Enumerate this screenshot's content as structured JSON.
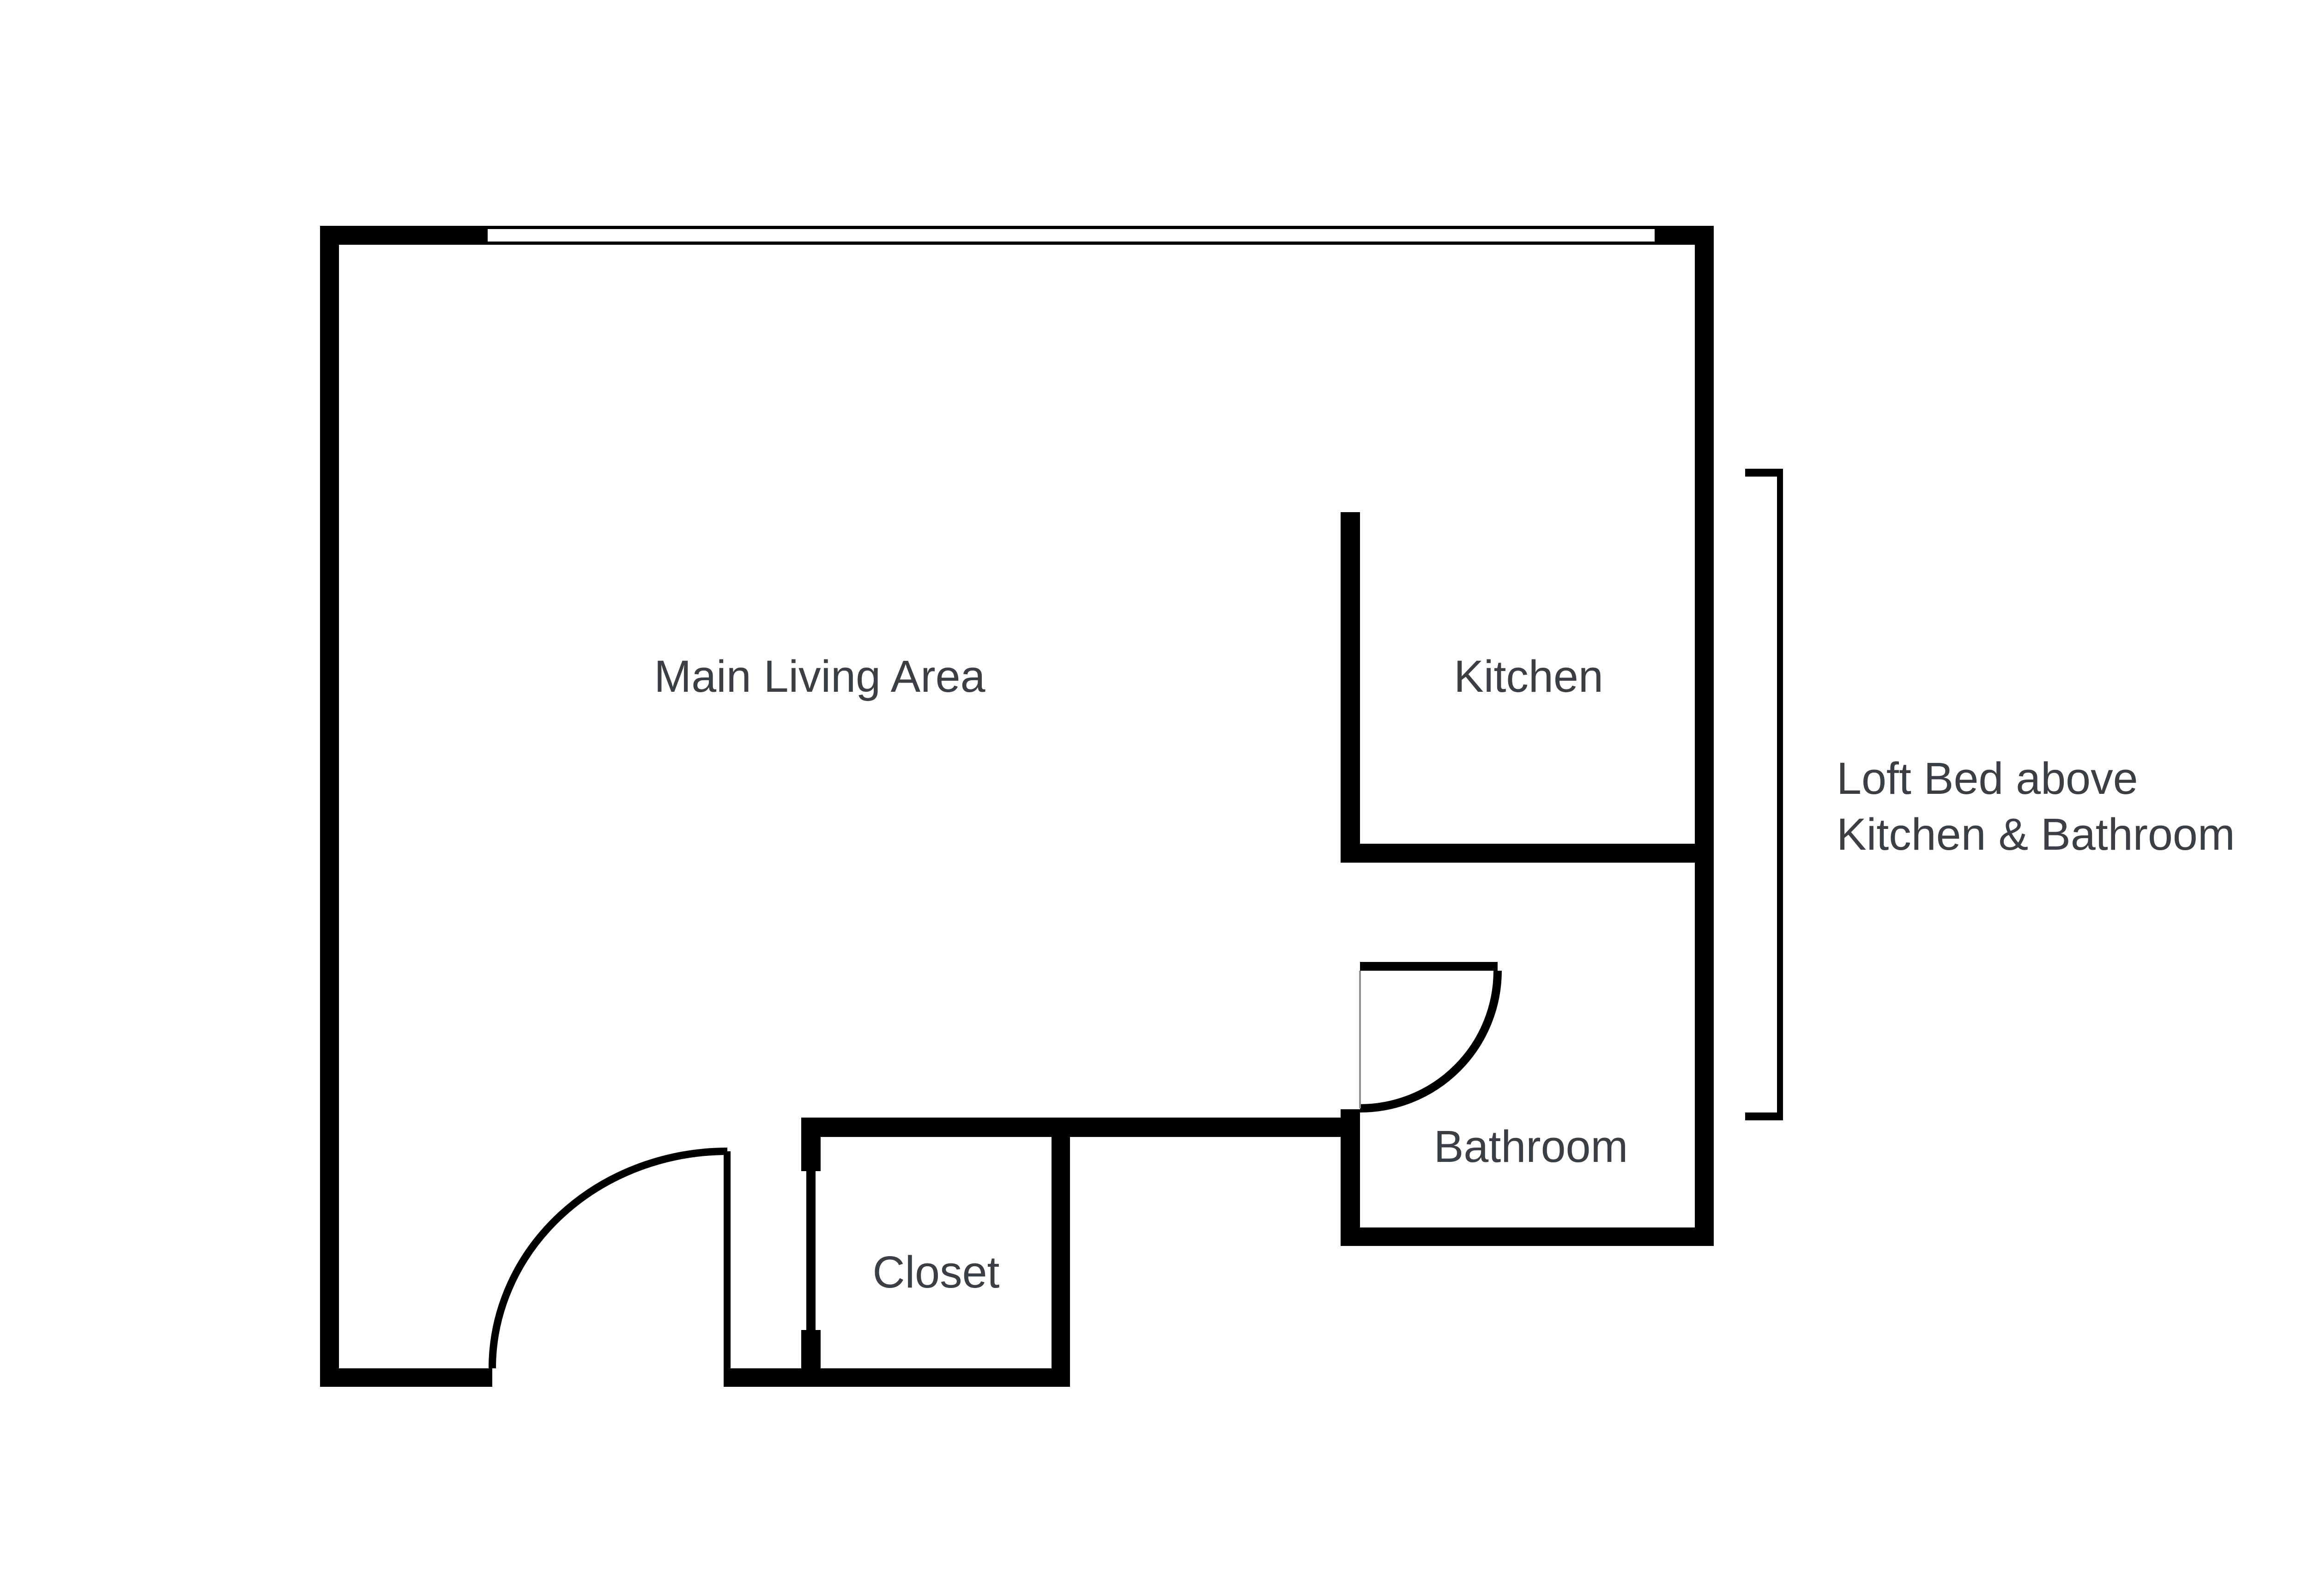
{
  "colors": {
    "wall": "#000000",
    "label": "#3a3e45",
    "door_hairline": "#8f8f8f"
  },
  "floor_plan": {
    "rooms": [
      {
        "id": "main-living-area",
        "label": "Main Living Area"
      },
      {
        "id": "kitchen",
        "label": "Kitchen"
      },
      {
        "id": "bathroom",
        "label": "Bathroom"
      },
      {
        "id": "closet",
        "label": "Closet"
      }
    ],
    "annotation": {
      "line1": "Loft Bed above",
      "line2": "Kitchen & Bathroom"
    }
  }
}
